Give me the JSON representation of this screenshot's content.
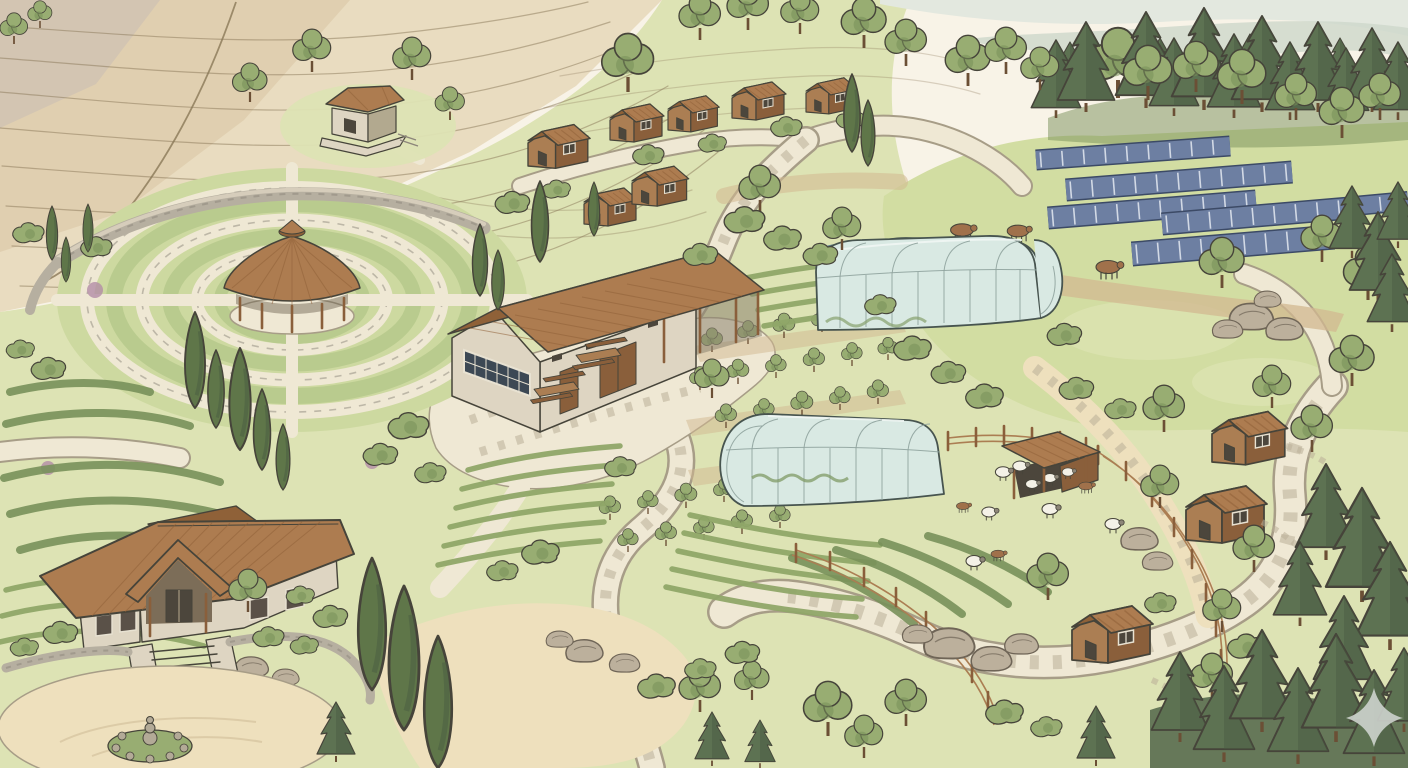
{
  "scene": {
    "type": "illustration",
    "medium": "ink and watercolor aerial view",
    "subject": "Permaculture eco-village farmstead with terraced hills, mandala garden, barn, greenhouses, solar array, pastures, cabins and winding stone paths",
    "visible_text": "none"
  },
  "palette": {
    "paper": "#f8f3e7",
    "terrace": "#e9dcc0",
    "terraceShade": "#d8c5a3",
    "terraceDark": "#c6b092",
    "contour": "#8a7858",
    "mist1": "#e3e8df",
    "mist2": "#cdd7ca",
    "grassLight": "#dde3b4",
    "grassMid": "#cdd9a0",
    "meadow": "#d2dda2",
    "meadowLite": "#e1e7ba",
    "foliage": "#98ad72",
    "foliageDark": "#78905a",
    "cypress": "#5f7649",
    "pine": "#5d7252",
    "pineDark": "#495c42",
    "ink": "#46443a",
    "roof": "#ad7c50",
    "roofDark": "#8f6138",
    "wood": "#ab7e53",
    "woodDark": "#8a5f3b",
    "stoneWall": "#ded5c2",
    "stoneEdge": "#b2a98f",
    "wallStone": "#b6afa0",
    "wallDark": "#8c857a",
    "path": "#efe8d4",
    "pathEdge": "#a79d87",
    "pathDash": "#b9af98",
    "sand": "#eee0bd",
    "mulch": "#d2b890",
    "glass": "#d9e9e3",
    "glassLine": "#8fa39d",
    "frame": "#47544f",
    "solar": "#6d7fa2",
    "solarEdge": "#3c4a66",
    "water": "#9ac2d3",
    "waterEdge": "#5b7d91",
    "sheep": "#f4f1e7",
    "sheepHead": "#8d8678",
    "animal": "#a0714b",
    "rock": "#bcb09c",
    "rockDark": "#6f6557",
    "crop": "#8fa768",
    "bed": "#b9cb8e",
    "flower": "#b38ca6",
    "trunk": "#6b4f35",
    "interior": "#4c463c",
    "watermark": "#cdd3cd"
  },
  "elements": {
    "hillside": {
      "label": "Terraced hillside with contour lines"
    },
    "hilltopPavilion": {
      "label": "Hilltop pavilion with olive trees"
    },
    "cabins": {
      "label": "Row of small guest cabins"
    },
    "pineForest": {
      "label": "Pine forest ridge"
    },
    "mist": {
      "label": "Misty hills in the distance"
    },
    "solar": {
      "label": "Ground-mounted solar panel array"
    },
    "meadow": {
      "label": "Grazing meadow"
    },
    "cows": {
      "label": "Grazing cows"
    },
    "mandala": {
      "label": "Circular mandala garden with concentric beds"
    },
    "gardenPavilion": {
      "label": "Round garden pavilion with conical roof"
    },
    "wall": {
      "label": "Curved stone retaining wall"
    },
    "herbGarden": {
      "label": "Herb garden beds"
    },
    "barn": {
      "label": "Stone community barn with covered porch"
    },
    "tables": {
      "label": "Outdoor picnic tables on patio"
    },
    "greenhouses": {
      "label": "Arched glass greenhouses"
    },
    "pond": {
      "label": "Small pond"
    },
    "orchard": {
      "label": "Fruit tree orchard"
    },
    "vegBeds": {
      "label": "Vegetable row beds"
    },
    "shelter": {
      "label": "Open livestock shelter"
    },
    "fences": {
      "label": "Split-rail fenced pens"
    },
    "flock": {
      "label": "Sheep and goats in pasture"
    },
    "guestCabins": {
      "label": "Wooden cabins among trees"
    },
    "paths": {
      "label": "Winding flagstone paths"
    },
    "farmhouse": {
      "label": "Stone farmhouse with entry steps"
    },
    "courtyard": {
      "label": "Sandy entry courtyard with rock cairn"
    },
    "cypresses": {
      "label": "Tall cypress trees"
    },
    "rocks": {
      "label": "Boulder outcrops"
    },
    "pinesEdge": {
      "label": "Pine trees along right edge and corner"
    },
    "treesScatter": {
      "label": "Scattered shade trees"
    },
    "bushes": {
      "label": "Shrubs and hedges"
    },
    "watermark": {
      "label": "Four-point star watermark"
    }
  }
}
